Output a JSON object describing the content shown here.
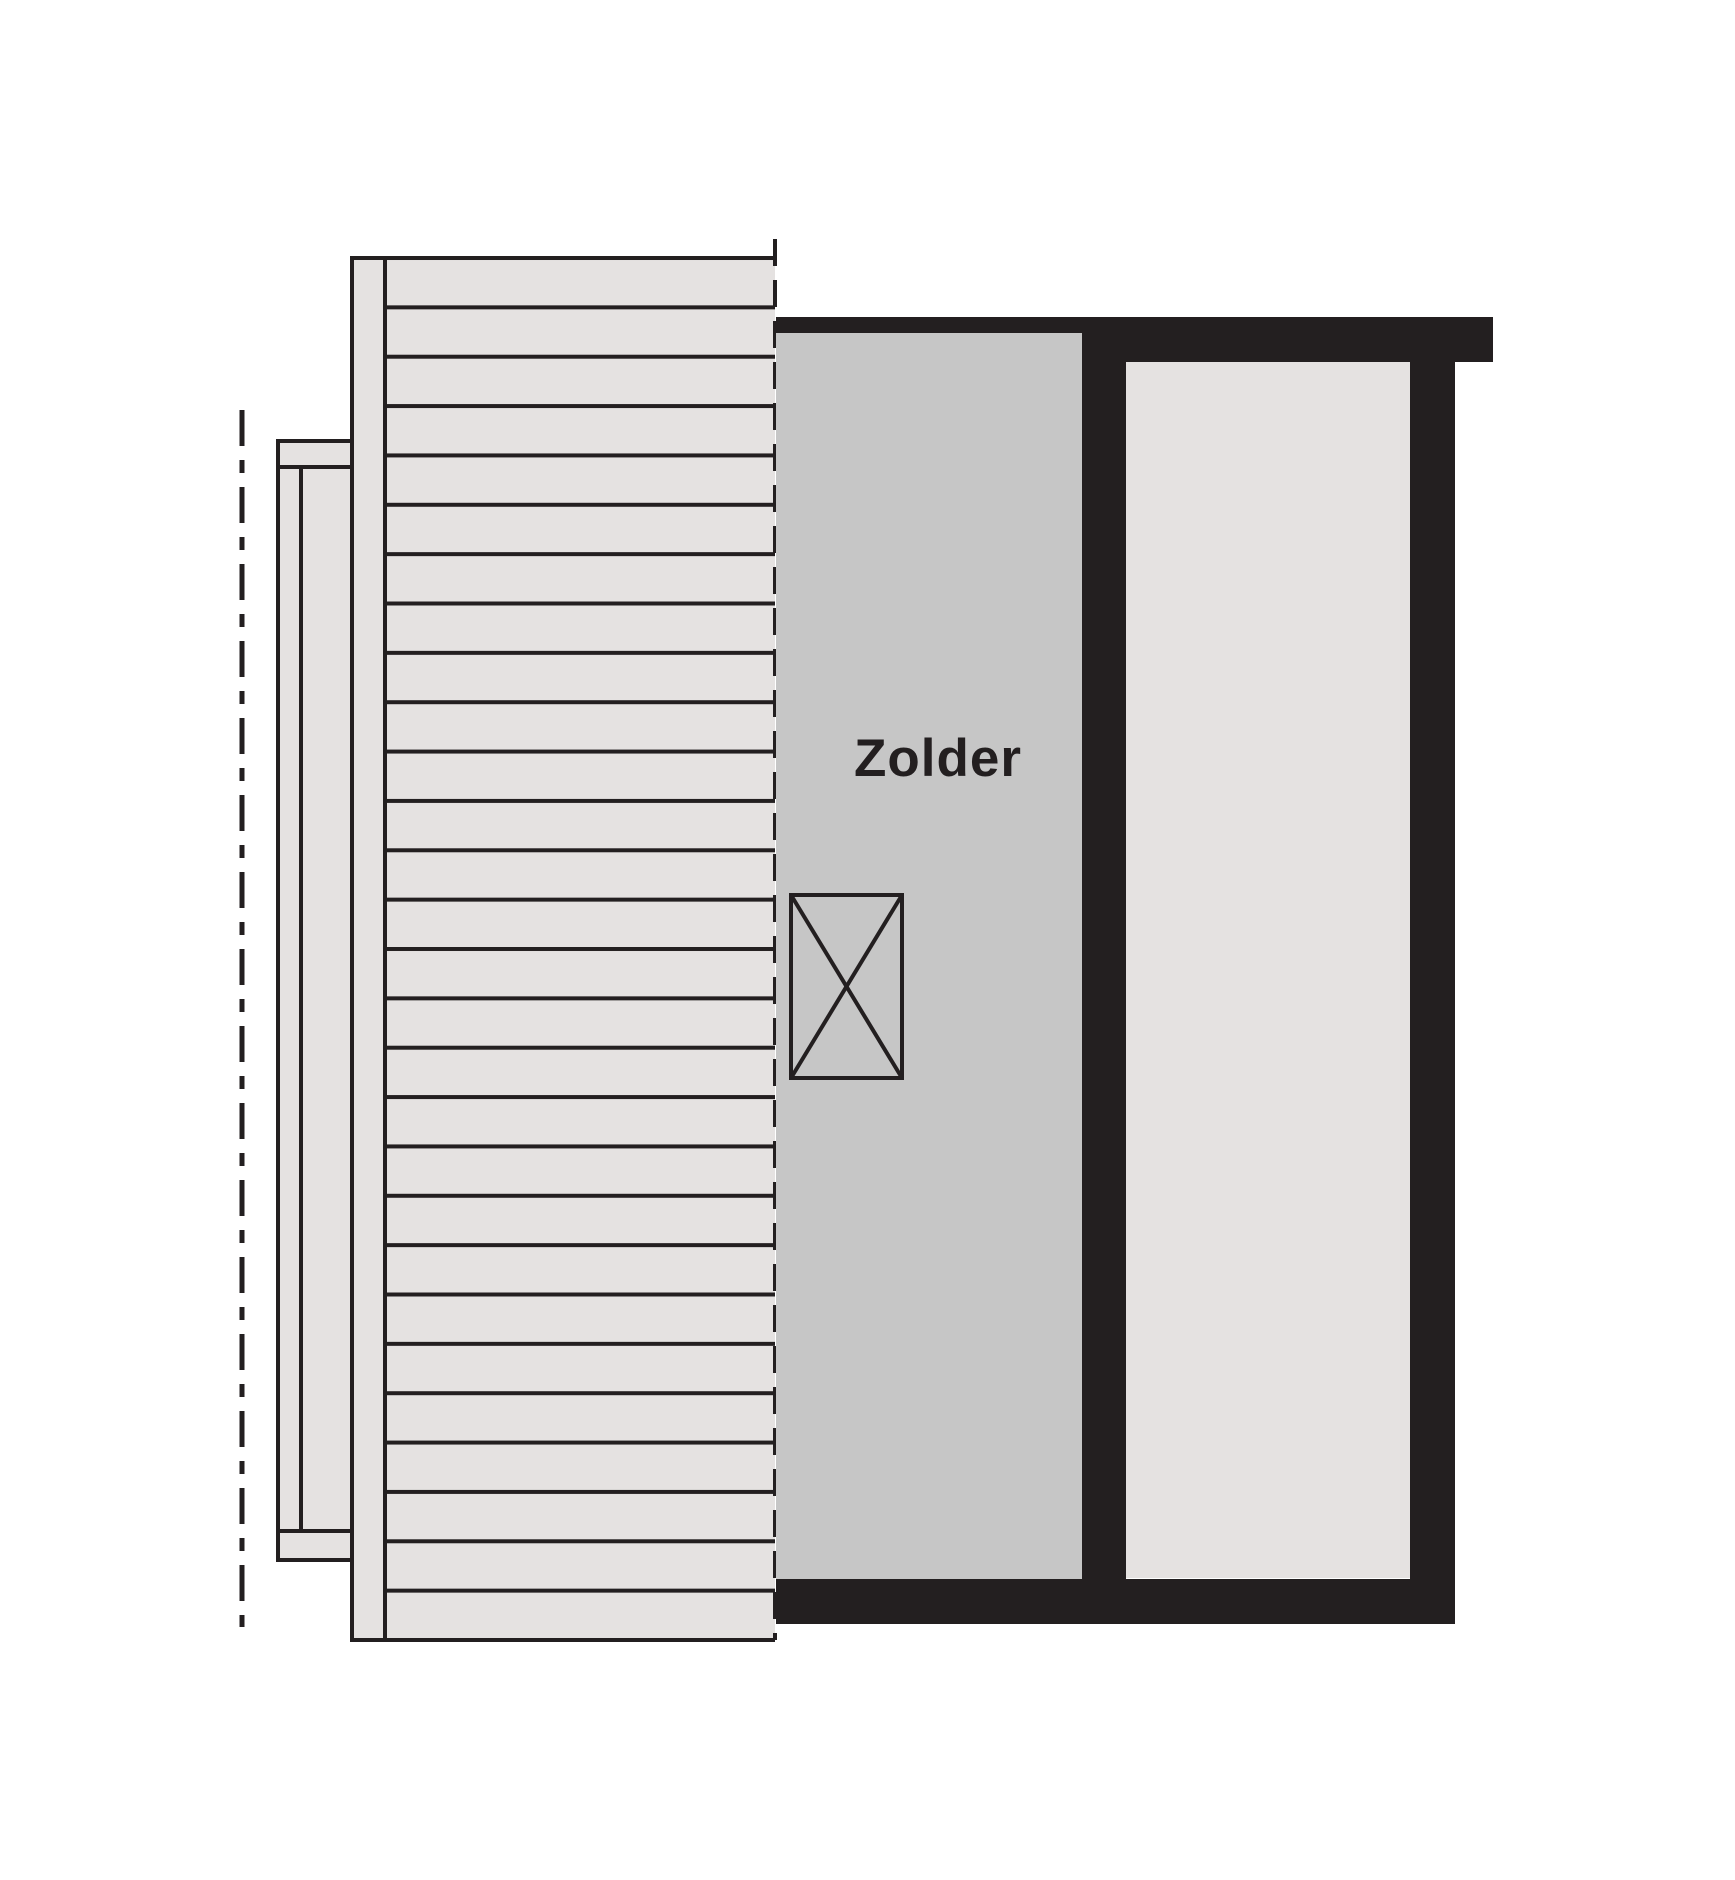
{
  "plan": {
    "room_label": "Zolder",
    "colors": {
      "wall": "#231f20",
      "line": "#231f20",
      "attic_floor": "#c6c6c6",
      "surface": "#e5e2e1",
      "background": "#ffffff"
    },
    "markers": {
      "crossed_box": "crossed-rectangle-symbol",
      "center_line": "dash-dot-centerline",
      "roof_edge": "dashed-line",
      "roof_deck_hatch": "horizontal-plank-lines",
      "plank_rows": 28
    }
  }
}
